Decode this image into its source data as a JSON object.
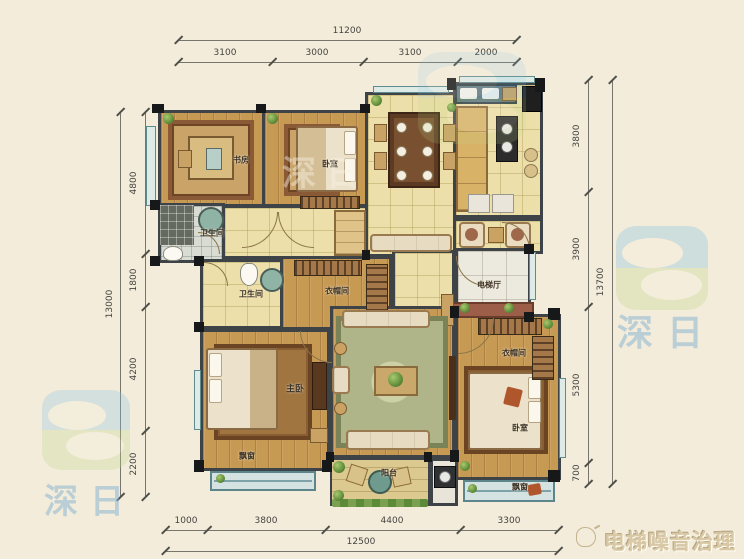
{
  "canvas": {
    "width": 744,
    "height": 559,
    "background": "#f3ecdb"
  },
  "dims": {
    "top": {
      "total": "11200",
      "segments": [
        "3100",
        "3000",
        "3100",
        "2000"
      ]
    },
    "left": {
      "total": "13000",
      "segments": [
        "4800",
        "1800",
        "4200",
        "2200"
      ]
    },
    "right": {
      "total": "13700",
      "segments": [
        "3800",
        "3900",
        "5300",
        "700"
      ]
    },
    "bottom": {
      "total": "12500",
      "segments": [
        "1000",
        "3800",
        "4400",
        "3300"
      ]
    }
  },
  "rooms": {
    "study": "书房",
    "bedroom_top": "卧室",
    "bathroom_1": "卫生间",
    "bathroom_2": "卫生间",
    "cloakroom_1": "衣帽间",
    "elevator_hall": "电梯厅",
    "master_bedroom": "主卧",
    "bay_window_master": "飘窗",
    "balcony": "阳台",
    "cloakroom_2": "衣帽间",
    "bedroom_2": "卧室",
    "bay_window_bedroom2": "飘窗"
  },
  "watermarks": {
    "brand": "深日",
    "footer": "电梯噪音治理"
  },
  "colors": {
    "wall": "#3d4347",
    "wood_floor": "#c79a54",
    "tile_floor": "#ecdfa9",
    "window_teal": "#5e8b8e",
    "logo_blue": "#8ac6e2",
    "logo_green": "#c3da8e",
    "brand_text": "#8fbcd8",
    "footer_text": "#d9c8a6"
  }
}
